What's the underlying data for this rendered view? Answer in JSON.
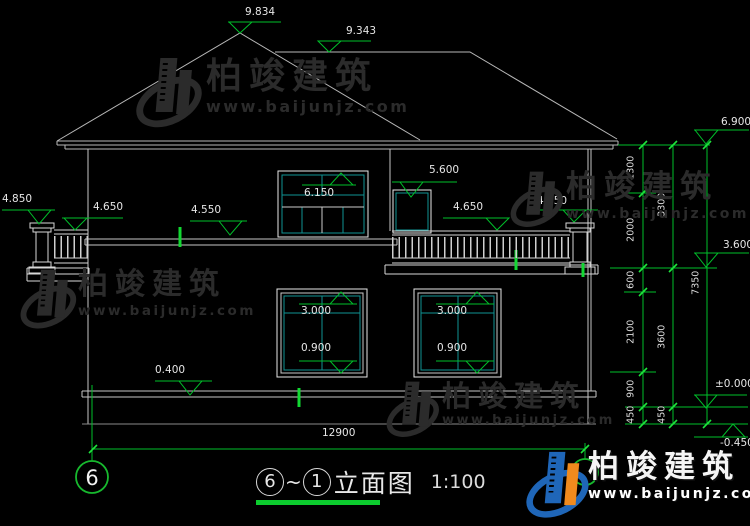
{
  "title_block": {
    "axis_start": "6",
    "axis_tilde": "~",
    "axis_end": "1",
    "drawing_name": "立面图",
    "scale": "1:100"
  },
  "grid_bubbles": {
    "left": "6"
  },
  "elevation_markers": {
    "roof_peak": "9.834",
    "roof_ridge": "9.343",
    "eave": "6.900",
    "second_floor": "3.600",
    "ground_floor": "±0.000",
    "outdoor_ground": "-0.450",
    "left_newel_cap": "4.850",
    "left_railing": "4.650",
    "floor_band": "4.550",
    "door_top": "6.150",
    "upper_window_top": "5.600",
    "balcony_railing": "4.650",
    "right_newel_cap": "4.850",
    "plinth_top": "0.400",
    "window1_top": "3.000",
    "window1_sill": "0.900",
    "window2_top": "3.000",
    "window2_sill": "0.900"
  },
  "dimensions": {
    "right_inner": [
      "1300",
      "2000",
      "600",
      "2100",
      "900",
      "450"
    ],
    "right_middle": [
      "3300",
      "3600",
      "450"
    ],
    "right_outer": [
      "7350"
    ],
    "bottom_total": "12900"
  },
  "watermark": {
    "brand": "柏竣建筑",
    "url": "www.baijunjz.com"
  },
  "logo": {
    "brand": "柏竣建筑",
    "url": "www.baijunjz.com"
  },
  "colors": {
    "annotation_green": "#00bf2a",
    "mullion_teal": "#0f9394",
    "logo_blue": "#1f66b8",
    "logo_orange": "#f08a1d"
  }
}
